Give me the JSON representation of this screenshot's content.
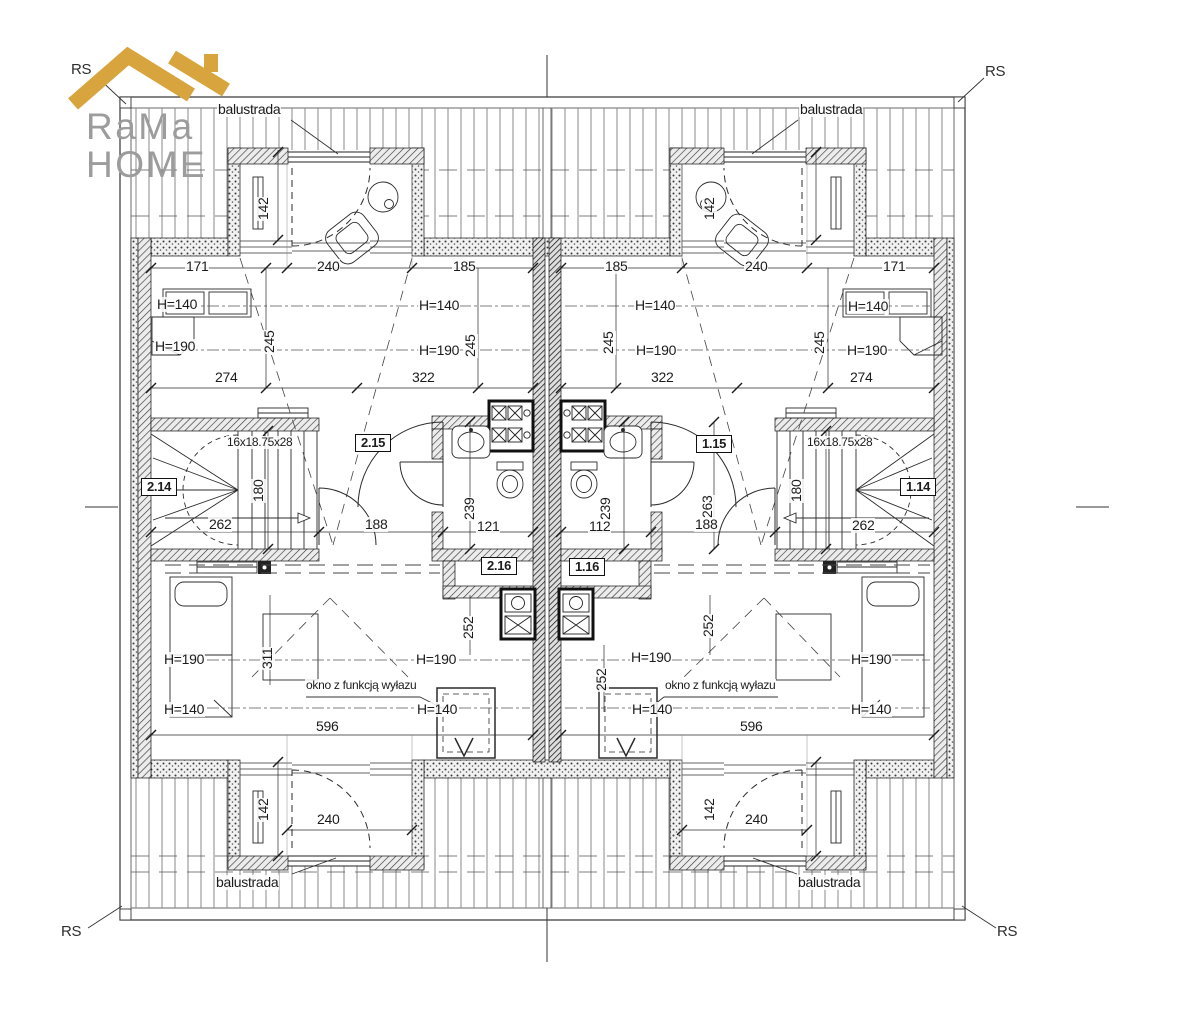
{
  "logo": {
    "line1": "RaMa",
    "line2": "HOME"
  },
  "colors": {
    "gold": "#D8A43E",
    "logo_gray": "#9C9C9C",
    "line": "#2B2B2B"
  },
  "drawing_title": "attic floor plan of a semi-detached house",
  "labels": [
    {
      "name": "rs-marker-top-left",
      "text": "RS",
      "x": 70,
      "y": 62,
      "cls": "rs"
    },
    {
      "name": "rs-marker-top-right",
      "text": "RS",
      "x": 984,
      "y": 64,
      "cls": "rs"
    },
    {
      "name": "rs-marker-bottom-left",
      "text": "RS",
      "x": 60,
      "y": 924,
      "cls": "rs"
    },
    {
      "name": "rs-marker-bottom-right",
      "text": "RS",
      "x": 996,
      "y": 924,
      "cls": "rs"
    },
    {
      "name": "balustrada-top-left",
      "text": "balustrada",
      "x": 217,
      "y": 102
    },
    {
      "name": "balustrada-top-right",
      "text": "balustrada",
      "x": 799,
      "y": 102
    },
    {
      "name": "balustrada-bottom-left",
      "text": "balustrada",
      "x": 215,
      "y": 875
    },
    {
      "name": "balustrada-bottom-right",
      "text": "balustrada",
      "x": 797,
      "y": 875
    },
    {
      "name": "dim-171-left",
      "text": "171",
      "x": 185,
      "y": 259
    },
    {
      "name": "dim-240-top-left",
      "text": "240",
      "x": 316,
      "y": 259
    },
    {
      "name": "dim-185-left",
      "text": "185",
      "x": 452,
      "y": 259
    },
    {
      "name": "dim-185-right",
      "text": "185",
      "x": 604,
      "y": 259
    },
    {
      "name": "dim-240-top-right",
      "text": "240",
      "x": 744,
      "y": 259
    },
    {
      "name": "dim-171-right",
      "text": "171",
      "x": 882,
      "y": 259
    },
    {
      "name": "dim-274-left",
      "text": "274",
      "x": 214,
      "y": 370
    },
    {
      "name": "dim-322-left",
      "text": "322",
      "x": 411,
      "y": 370
    },
    {
      "name": "dim-322-right",
      "text": "322",
      "x": 650,
      "y": 370
    },
    {
      "name": "dim-274-right",
      "text": "274",
      "x": 849,
      "y": 370
    },
    {
      "name": "h140-room2-left",
      "text": "H=140",
      "x": 156,
      "y": 297
    },
    {
      "name": "h190-room2-left",
      "text": "H=190",
      "x": 154,
      "y": 339
    },
    {
      "name": "h140-room2-right",
      "text": "H=140",
      "x": 418,
      "y": 298
    },
    {
      "name": "h190-room2-right",
      "text": "H=190",
      "x": 418,
      "y": 343
    },
    {
      "name": "h140-room1-left",
      "text": "H=140",
      "x": 634,
      "y": 298
    },
    {
      "name": "h190-room1-left",
      "text": "H=190",
      "x": 635,
      "y": 343
    },
    {
      "name": "h140-room1-right",
      "text": "H=140",
      "x": 847,
      "y": 299
    },
    {
      "name": "h190-room1-right",
      "text": "H=190",
      "x": 846,
      "y": 343
    },
    {
      "name": "dim-245-a",
      "text": "245",
      "x": 262,
      "y": 324,
      "rot": true
    },
    {
      "name": "dim-245-b",
      "text": "245",
      "x": 463,
      "y": 328,
      "rot": true
    },
    {
      "name": "dim-245-c",
      "text": "245",
      "x": 601,
      "y": 325,
      "rot": true
    },
    {
      "name": "dim-245-d",
      "text": "245",
      "x": 812,
      "y": 325,
      "rot": true
    },
    {
      "name": "dim-142-top-left",
      "text": "142",
      "x": 256,
      "y": 191,
      "rot": true
    },
    {
      "name": "dim-142-top-right",
      "text": "142",
      "x": 702,
      "y": 191,
      "rot": true
    },
    {
      "name": "dim-142-bottom-left",
      "text": "142",
      "x": 256,
      "y": 792,
      "rot": true
    },
    {
      "name": "dim-142-bottom-right",
      "text": "142",
      "x": 702,
      "y": 792,
      "rot": true
    },
    {
      "name": "stair-spec-left",
      "text": "16x18.75x28",
      "x": 226,
      "y": 436,
      "cls": "sm"
    },
    {
      "name": "stair-spec-right",
      "text": "16x18.75x28",
      "x": 806,
      "y": 436,
      "cls": "sm"
    },
    {
      "name": "dim-262-left",
      "text": "262",
      "x": 208,
      "y": 517
    },
    {
      "name": "dim-262-right",
      "text": "262",
      "x": 851,
      "y": 518
    },
    {
      "name": "dim-180-left",
      "text": "180",
      "x": 251,
      "y": 473,
      "rot": true
    },
    {
      "name": "dim-180-right",
      "text": "180",
      "x": 789,
      "y": 473,
      "rot": true
    },
    {
      "name": "dim-188-left",
      "text": "188",
      "x": 364,
      "y": 517
    },
    {
      "name": "dim-121",
      "text": "121",
      "x": 476,
      "y": 519
    },
    {
      "name": "dim-112",
      "text": "112",
      "x": 588,
      "y": 519
    },
    {
      "name": "dim-188-right",
      "text": "188",
      "x": 694,
      "y": 517
    },
    {
      "name": "dim-263-right",
      "text": "263",
      "x": 700,
      "y": 489,
      "rot": true
    },
    {
      "name": "dim-239-left",
      "text": "239",
      "x": 462,
      "y": 491,
      "rot": true
    },
    {
      "name": "dim-239-right",
      "text": "239",
      "x": 598,
      "y": 491,
      "rot": true
    },
    {
      "name": "room-number-2-15",
      "text": "2.15",
      "x": 355,
      "y": 434,
      "cls": "box"
    },
    {
      "name": "room-number-1-15",
      "text": "1.15",
      "x": 696,
      "y": 435,
      "cls": "box"
    },
    {
      "name": "room-number-2-14",
      "text": "2.14",
      "x": 141,
      "y": 478,
      "cls": "box"
    },
    {
      "name": "room-number-1-14",
      "text": "1.14",
      "x": 900,
      "y": 478,
      "cls": "box"
    },
    {
      "name": "room-number-2-16",
      "text": "2.16",
      "x": 481,
      "y": 557,
      "cls": "box"
    },
    {
      "name": "room-number-1-16",
      "text": "1.16",
      "x": 569,
      "y": 558,
      "cls": "box"
    },
    {
      "name": "h190-room4-left",
      "text": "H=190",
      "x": 163,
      "y": 652
    },
    {
      "name": "h140-room4-left",
      "text": "H=140",
      "x": 163,
      "y": 702
    },
    {
      "name": "h190-room4-right",
      "text": "H=190",
      "x": 415,
      "y": 652
    },
    {
      "name": "h140-room4-right",
      "text": "H=140",
      "x": 416,
      "y": 702
    },
    {
      "name": "h190-room3-left",
      "text": "H=190",
      "x": 630,
      "y": 650
    },
    {
      "name": "h140-room3-left",
      "text": "H=140",
      "x": 631,
      "y": 702
    },
    {
      "name": "h190-room3-right",
      "text": "H=190",
      "x": 850,
      "y": 652
    },
    {
      "name": "h140-room3-right",
      "text": "H=140",
      "x": 850,
      "y": 702
    },
    {
      "name": "dim-596-left",
      "text": "596",
      "x": 315,
      "y": 719
    },
    {
      "name": "dim-596-right",
      "text": "596",
      "x": 739,
      "y": 719
    },
    {
      "name": "dim-311",
      "text": "311",
      "x": 260,
      "y": 640,
      "rot": true
    },
    {
      "name": "dim-252-a",
      "text": "252",
      "x": 461,
      "y": 610,
      "rot": true
    },
    {
      "name": "dim-252-b",
      "text": "252",
      "x": 594,
      "y": 662,
      "rot": true
    },
    {
      "name": "dim-252-c",
      "text": "252",
      "x": 701,
      "y": 608,
      "rot": true
    },
    {
      "name": "roof-hatch-note-left",
      "text": "okno z funkcją wyłazu",
      "x": 305,
      "y": 679,
      "cls": "sm"
    },
    {
      "name": "roof-hatch-note-right",
      "text": "okno z funkcją wyłazu",
      "x": 664,
      "y": 679,
      "cls": "sm"
    },
    {
      "name": "dim-240-bottom-left",
      "text": "240",
      "x": 316,
      "y": 812
    },
    {
      "name": "dim-240-bottom-right",
      "text": "240",
      "x": 744,
      "y": 812
    }
  ]
}
